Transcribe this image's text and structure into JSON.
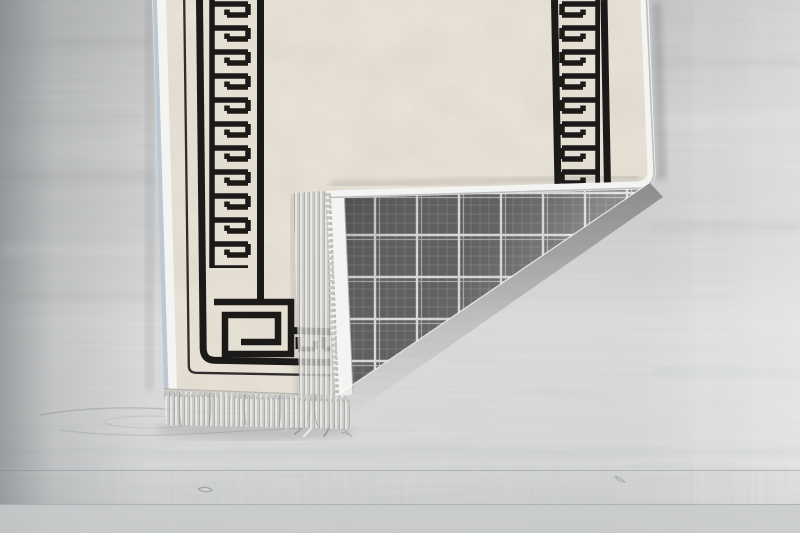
{
  "scene": {
    "type": "product-photograph",
    "description": "Beige rug with black Greek key meander border, bottom-right corner folded over revealing a gray plaid woven underside with off-white fringe tassels, lying on a whitewashed light gray wood plank floor.",
    "background": {
      "name": "whitewashed-wood-floor",
      "features": [
        "horizontal grain streaks",
        "darker left edge",
        "lighter sheen on right",
        "rough grain band near bottom",
        "small knots"
      ]
    },
    "rug": {
      "front": {
        "field": "mottled cream",
        "border_style": "greek-key meander between black rail lines",
        "borders": [
          "left vertical band",
          "right vertical band",
          "bottom horizontal band",
          "large corner spiral motif"
        ],
        "edges": "white binding with pale blue selvedge line on left edge"
      },
      "underside": {
        "pattern": "plaid / tartan weave",
        "tones": "charcoal gray with light gray windowpane lines"
      },
      "fold": {
        "state": "bottom-right corner folded up-left",
        "visible": [
          "plaid backing triangle",
          "white binding strips",
          "vertical fringe on folded edge",
          "diagonal crease with floor shadow"
        ]
      },
      "fringe": {
        "color": "off-white",
        "locations": [
          "bottom edge",
          "folded corner edge"
        ]
      }
    }
  },
  "colors": {
    "floor_base": "#d7d8d9",
    "floor_dark_band": "#c9cbcc",
    "floor_grain": "#7e8284",
    "rug_field": "#eae4d9",
    "rug_black": "#1c1a19",
    "rug_binding": "#f4f4f2",
    "rug_edge_blue": "#bcc8d4",
    "plaid_base": "#5f6061",
    "plaid_major": "#d9d9d7",
    "plaid_mid": "#a8a8a6",
    "plaid_minor": "#8b8b89",
    "fringe_light": "#e9e9e6",
    "fringe_mid": "#c6c6c3",
    "fringe_dark": "#9d9d9b",
    "shadow": "#54565a"
  }
}
